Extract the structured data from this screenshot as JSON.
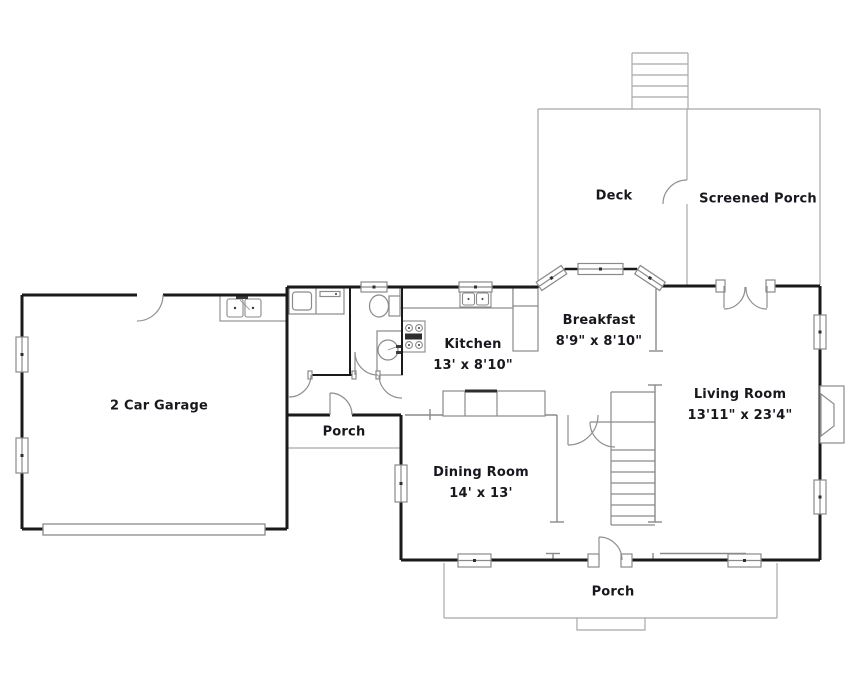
{
  "colors": {
    "wall": "#1a1a1a",
    "thin_line": "#8a8a8a",
    "porch_outline": "#a8a8a8",
    "text": "#17171e",
    "background": "#ffffff"
  },
  "rooms": {
    "garage": {
      "label": "2 Car Garage"
    },
    "side_porch": {
      "label": "Porch"
    },
    "kitchen": {
      "label": "Kitchen",
      "dims": "13' x 8'10\""
    },
    "breakfast": {
      "label": "Breakfast",
      "dims": "8'9\" x 8'10\""
    },
    "living_room": {
      "label": "Living Room",
      "dims": "13'11\" x 23'4\""
    },
    "dining_room": {
      "label": "Dining Room",
      "dims": "14' x 13'"
    },
    "deck": {
      "label": "Deck"
    },
    "screened_porch": {
      "label": "Screened Porch"
    },
    "front_porch": {
      "label": "Porch"
    }
  },
  "fixtures": [
    "washer-dryer",
    "laundry-sink",
    "toilet",
    "vanity-sink",
    "range-stove",
    "kitchen-sink",
    "refrigerator",
    "buffet-cabinet",
    "fireplace",
    "stairs",
    "garage-door",
    "deck-steps",
    "porch-steps",
    "bay-window"
  ]
}
